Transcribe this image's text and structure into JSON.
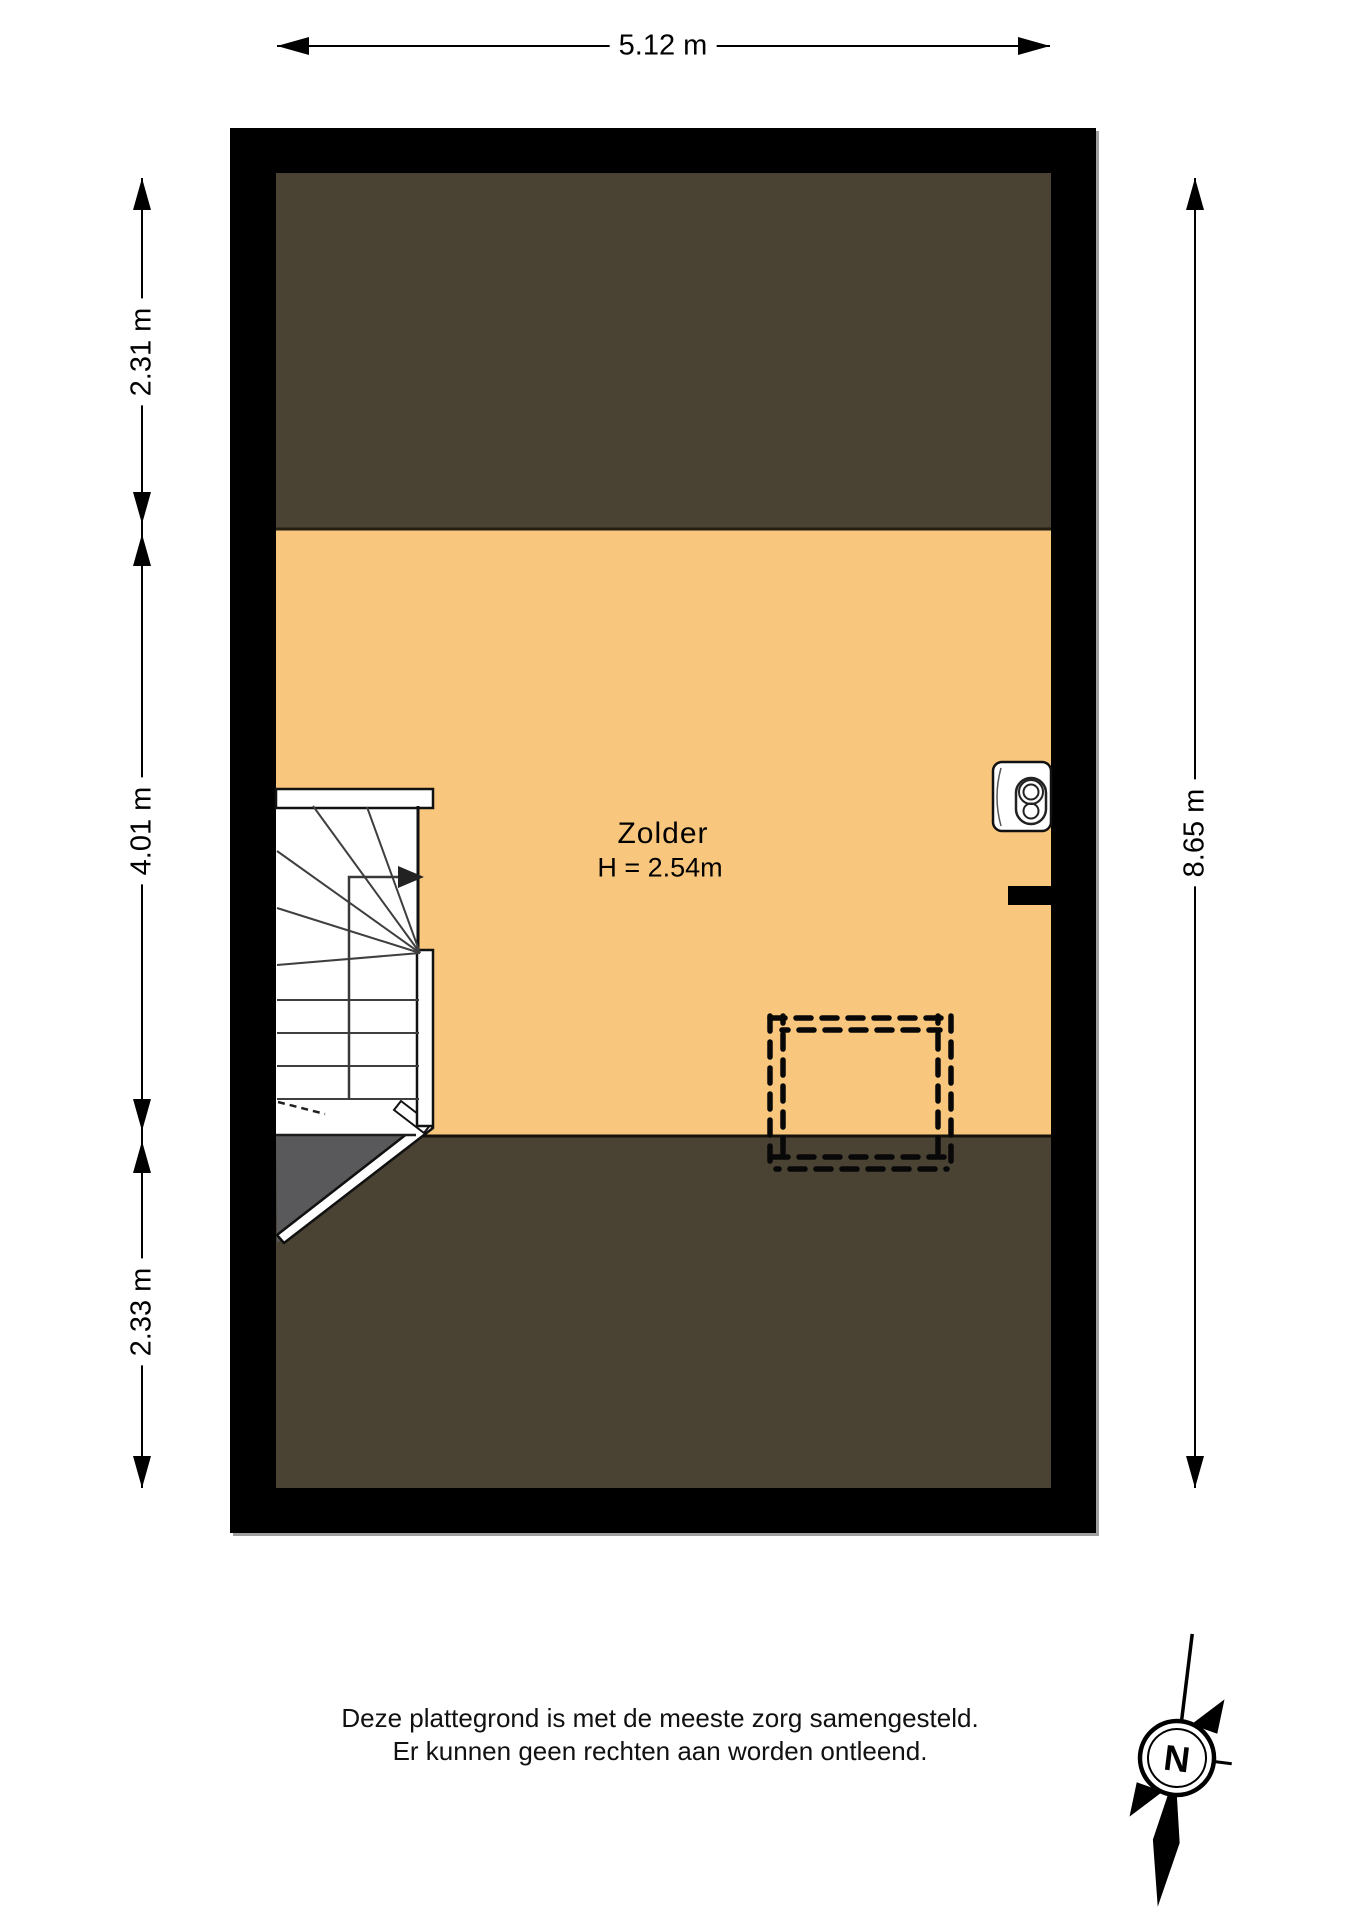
{
  "plan": {
    "room": {
      "name": "Zolder",
      "height_label": "H = 2.54m"
    },
    "dimensions": {
      "width_top": "5.12 m",
      "left_upper": "2.31 m",
      "left_middle": "4.01 m",
      "left_lower": "2.33 m",
      "right_full": "8.65 m"
    },
    "colors": {
      "floor": "#F8C77D",
      "low_headroom_zone": "#4A4233",
      "stair_landing_gray": "#59595B",
      "wall": "#000000"
    },
    "icons": {
      "boiler": "boiler-icon",
      "stairs": "staircase",
      "dormer": "dormer-dashed-outline",
      "compass": "compass-rose-icon"
    }
  },
  "footer": {
    "disclaimer_line1": "Deze plattegrond is met de meeste zorg samengesteld.",
    "disclaimer_line2": "Er kunnen geen rechten aan worden ontleend."
  },
  "compass": {
    "north_label": "N"
  }
}
